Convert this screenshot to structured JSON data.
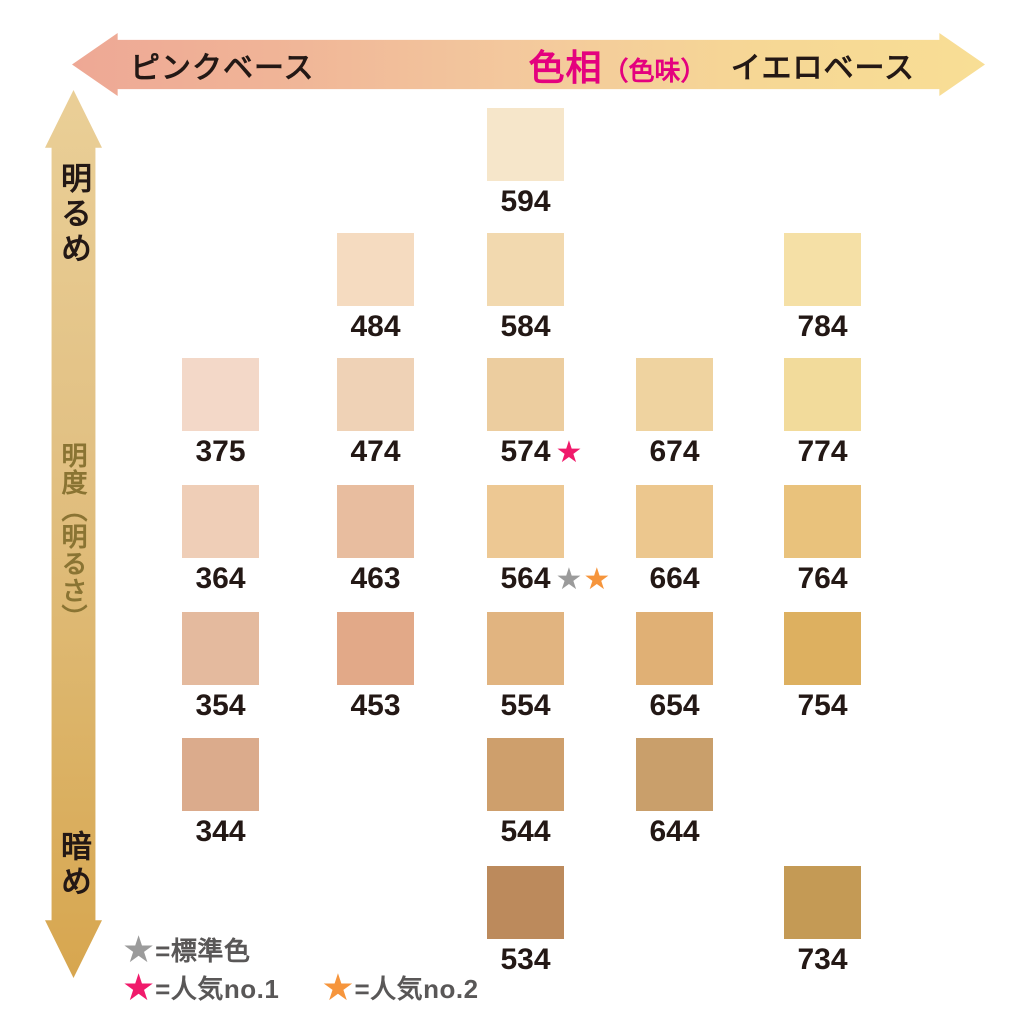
{
  "chart_data": {
    "type": "heatmap",
    "title": "ファンデーション色相・明度シェードマップ",
    "x_axis": {
      "left_label": "ピンクベース",
      "title": "色相",
      "title_sub": "（色味）",
      "right_label": "イエロベース",
      "gradient_left": "#EEA895",
      "gradient_right": "#F8DE95"
    },
    "y_axis": {
      "top_label": "明るめ",
      "title": "明度（明るさ）",
      "bottom_label": "暗め",
      "gradient_top": "#EACF97",
      "gradient_bottom": "#D7A64F"
    },
    "legend": [
      {
        "symbol": "star",
        "color": "#9B9B9B",
        "label": "=標準色"
      },
      {
        "symbol": "star",
        "color": "#F01A6B",
        "label": "=人気no.1"
      },
      {
        "symbol": "star",
        "color": "#F6953C",
        "label": "=人気no.2"
      }
    ],
    "grid": {
      "columns": 5,
      "rows": 7
    },
    "cells": [
      {
        "code": "594",
        "col": 3,
        "row": 1,
        "color": "#F6E6CA",
        "stars": []
      },
      {
        "code": "484",
        "col": 2,
        "row": 2,
        "color": "#F5DBC0",
        "stars": []
      },
      {
        "code": "584",
        "col": 3,
        "row": 2,
        "color": "#F2D9AF",
        "stars": []
      },
      {
        "code": "784",
        "col": 5,
        "row": 2,
        "color": "#F5E0A6",
        "stars": []
      },
      {
        "code": "375",
        "col": 1,
        "row": 3,
        "color": "#F3D8C8",
        "stars": []
      },
      {
        "code": "474",
        "col": 2,
        "row": 3,
        "color": "#EFD2B6",
        "stars": []
      },
      {
        "code": "574",
        "col": 3,
        "row": 3,
        "color": "#ECCD9F",
        "stars": [
          {
            "meaning": "人気no.1",
            "color": "#F01A6B"
          }
        ]
      },
      {
        "code": "674",
        "col": 4,
        "row": 3,
        "color": "#EFD3A0",
        "stars": []
      },
      {
        "code": "774",
        "col": 5,
        "row": 3,
        "color": "#F2DB9B",
        "stars": []
      },
      {
        "code": "364",
        "col": 1,
        "row": 4,
        "color": "#EFCEB7",
        "stars": []
      },
      {
        "code": "463",
        "col": 2,
        "row": 4,
        "color": "#E8BD9F",
        "stars": []
      },
      {
        "code": "564",
        "col": 3,
        "row": 4,
        "color": "#EDC893",
        "stars": [
          {
            "meaning": "標準色",
            "color": "#9B9B9B"
          },
          {
            "meaning": "人気no.2",
            "color": "#F6953C"
          }
        ]
      },
      {
        "code": "664",
        "col": 4,
        "row": 4,
        "color": "#ECC78E",
        "stars": []
      },
      {
        "code": "764",
        "col": 5,
        "row": 4,
        "color": "#E9C27C",
        "stars": []
      },
      {
        "code": "354",
        "col": 1,
        "row": 5,
        "color": "#E4BA9E",
        "stars": []
      },
      {
        "code": "453",
        "col": 2,
        "row": 5,
        "color": "#E2A988",
        "stars": []
      },
      {
        "code": "554",
        "col": 3,
        "row": 5,
        "color": "#E1B480",
        "stars": []
      },
      {
        "code": "654",
        "col": 4,
        "row": 5,
        "color": "#E0B075",
        "stars": []
      },
      {
        "code": "754",
        "col": 5,
        "row": 5,
        "color": "#DDB060",
        "stars": []
      },
      {
        "code": "344",
        "col": 1,
        "row": 6,
        "color": "#DBAB8C",
        "stars": []
      },
      {
        "code": "544",
        "col": 3,
        "row": 6,
        "color": "#CE9F6C",
        "stars": []
      },
      {
        "code": "644",
        "col": 4,
        "row": 6,
        "color": "#C99F6B",
        "stars": []
      },
      {
        "code": "534",
        "col": 3,
        "row": 7,
        "color": "#BC8A5C",
        "stars": []
      },
      {
        "code": "734",
        "col": 5,
        "row": 7,
        "color": "#C49A55",
        "stars": []
      }
    ]
  },
  "star_glyph": "★"
}
